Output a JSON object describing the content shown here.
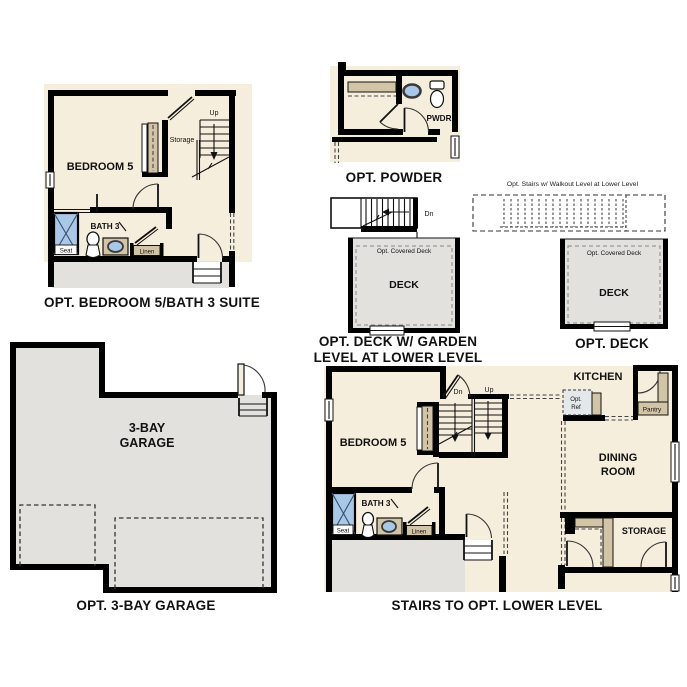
{
  "sheet": {
    "background": "#ffffff"
  },
  "colors": {
    "floor": "#f6eedd",
    "wall": "#000000",
    "deck_fill": "#e3e1de",
    "garage_fill": "#e3e1de",
    "shelf_fill": "#d2c5a7",
    "fixture_blue": "#a9c7e7",
    "ref_fill": "#e3e9ea"
  },
  "plans": {
    "bedroom5_suite": {
      "caption": "OPT. BEDROOM 5/BATH 3 SUITE",
      "labels": {
        "bedroom": "BEDROOM 5",
        "storage": "Storage",
        "up": "Up",
        "bath": "BATH 3",
        "seat": "Seat",
        "linen": "Linen"
      }
    },
    "powder": {
      "caption": "OPT. POWDER",
      "labels": {
        "pwdr": "PWDR"
      }
    },
    "deck_garden": {
      "caption_line1": "OPT. DECK W/ GARDEN",
      "caption_line2": "LEVEL AT LOWER LEVEL",
      "labels": {
        "dn": "Dn",
        "covered_deck": "Opt. Covered Deck",
        "deck": "DECK"
      }
    },
    "deck": {
      "caption": "OPT. DECK",
      "stairs_note": "Opt. Stairs w/ Walkout Level at Lower Level",
      "labels": {
        "covered_deck": "Opt. Covered Deck",
        "deck": "DECK"
      }
    },
    "garage": {
      "caption": "OPT. 3-BAY GARAGE",
      "labels": {
        "name_line1": "3-BAY",
        "name_line2": "GARAGE"
      }
    },
    "lower_level": {
      "caption": "STAIRS TO OPT. LOWER LEVEL",
      "labels": {
        "bedroom": "BEDROOM 5",
        "dn": "Dn",
        "up": "Up",
        "kitchen": "KITCHEN",
        "opt_ref_line1": "Opt.",
        "opt_ref_line2": "Ref",
        "pantry": "Pantry",
        "dining_line1": "DINING",
        "dining_line2": "ROOM",
        "storage": "STORAGE",
        "bath": "BATH 3",
        "seat": "Seat",
        "linen": "Linen"
      }
    }
  }
}
